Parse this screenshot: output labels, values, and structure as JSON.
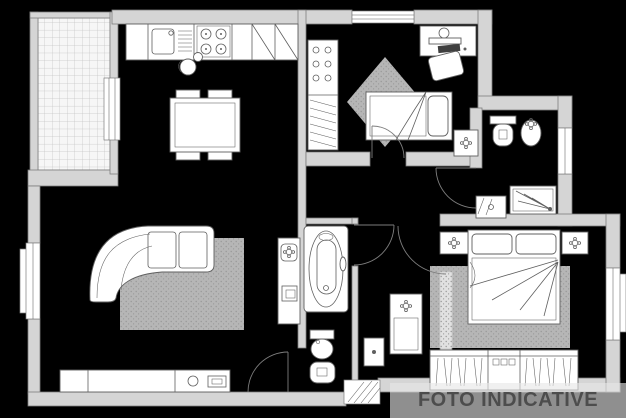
{
  "watermark": {
    "text": "FOTO INDICATIVE"
  },
  "palette": {
    "canvas-bg": "#000000",
    "wall-fill": "#d5d5d5",
    "wall-stroke": "#7d7d7d",
    "fixture-fill": "#ffffff",
    "fixture-stroke": "#5f5f5f",
    "tile-fill": "#f6f6f6",
    "tile-line": "#c4c4c4",
    "rug-base": "#e3e3e3",
    "rug-dot": "#989898",
    "keyboard-dark": "#3f3f3f",
    "watermark-band": "rgba(231,231,231,0.62)",
    "watermark-text": "#4d4d4d"
  },
  "plan": {
    "type": "apartment-floor-plan",
    "rooms": [
      {
        "name": "terrace"
      },
      {
        "name": "living-room-with-kitchen"
      },
      {
        "name": "small-bedroom"
      },
      {
        "name": "shower-bathroom"
      },
      {
        "name": "bathtub-bathroom"
      },
      {
        "name": "hallway"
      },
      {
        "name": "master-bedroom"
      }
    ],
    "symbols": [
      "tiled-floor",
      "kitchen-counter",
      "sink",
      "stove",
      "dining-table",
      "chairs",
      "curved-sofa",
      "rug",
      "tv-sideboard",
      "balcony-door",
      "windows",
      "desk-with-computer",
      "desk-chair",
      "single-bed",
      "wardrobe-closet",
      "nightstand",
      "toilet",
      "bidet",
      "shower",
      "washbasin",
      "bathtub",
      "double-bed",
      "wardrobe",
      "door-swing-arcs",
      "entrance-threshold"
    ]
  }
}
